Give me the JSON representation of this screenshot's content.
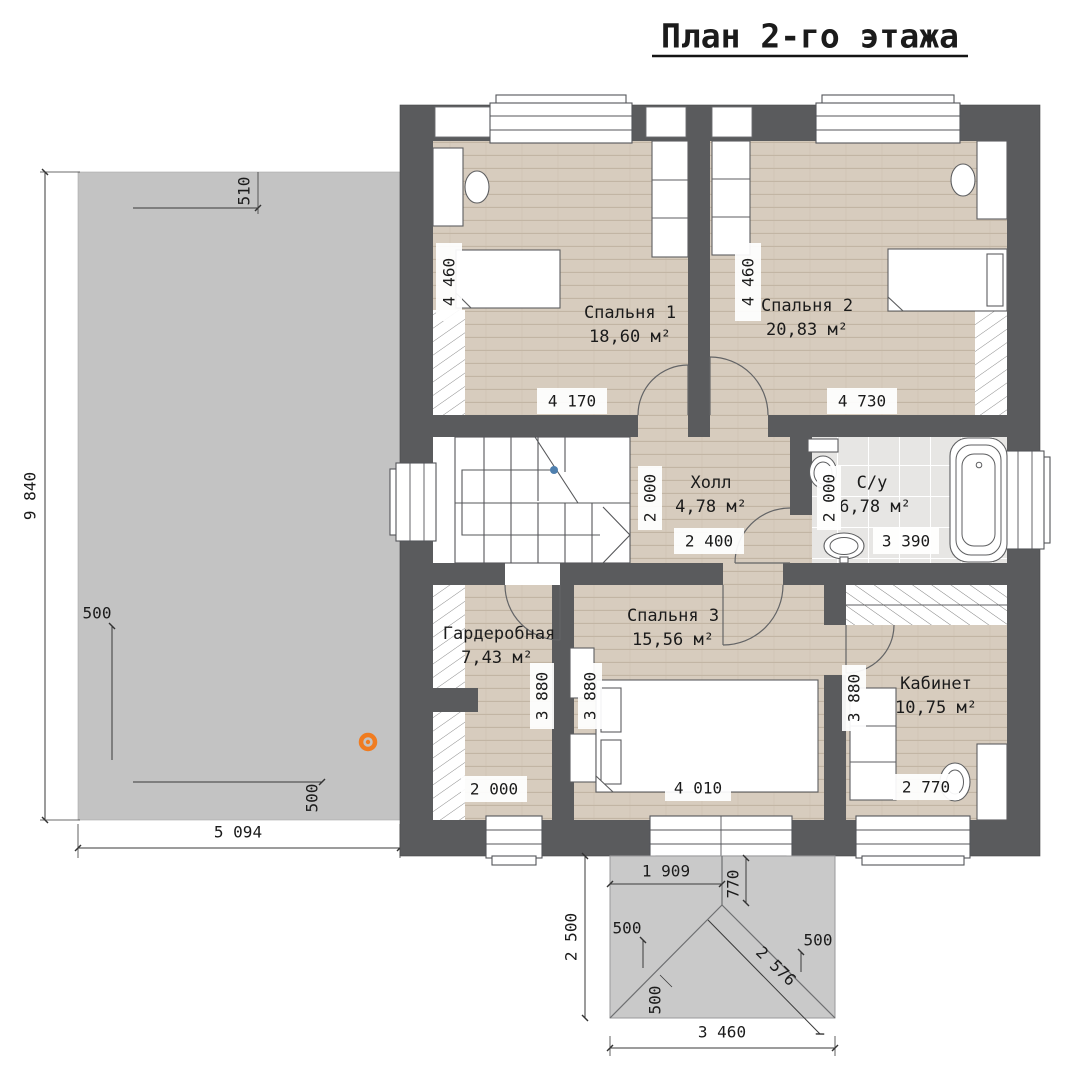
{
  "title": "План 2-го этажа",
  "rooms": {
    "bedroom1": {
      "name": "Спальня 1",
      "area": "18,60 м²"
    },
    "bedroom2": {
      "name": "Спальня 2",
      "area": "20,83 м²"
    },
    "hall": {
      "name": "Холл",
      "area": "4,78 м²"
    },
    "bathroom": {
      "name": "С/у",
      "area": "6,78 м²"
    },
    "wardrobe": {
      "name": "Гардеробная",
      "area": "7,43 м²"
    },
    "bedroom3": {
      "name": "Спальня 3",
      "area": "15,56 м²"
    },
    "office": {
      "name": "Кабинет",
      "area": "10,75 м²"
    }
  },
  "dims": {
    "terrace_height": "9 840",
    "terrace_510": "510",
    "terrace_500_top": "500",
    "terrace_500_bottom": "500",
    "terrace_width": "5 094",
    "bed1_v": "4 460",
    "bed1_h": "4 170",
    "bed2_v": "4 460",
    "bed2_h": "4 730",
    "hall_v": "2 000",
    "hall_h": "2 400",
    "bath_v": "2 000",
    "bath_h": "3 390",
    "ward_v": "3 880",
    "ward_h": "2 000",
    "bed3_v": "3 880",
    "bed3_h": "4 010",
    "office_v": "3 880",
    "office_h": "2 770",
    "porch_1909": "1 909",
    "porch_770": "770",
    "porch_2500": "2 500",
    "porch_500_left": "500",
    "porch_500_right": "500",
    "porch_500_bottom": "500",
    "porch_2576": "2 576",
    "porch_3460": "3 460"
  },
  "colors": {
    "wall": "#5a5b5d",
    "wood": "#d7ccbe",
    "wood_line": "#c2b5a4",
    "tile": "#e7e6e4",
    "tile_line": "#ffffff",
    "terrace": "#c3c3c3",
    "porch": "#c9c9c9",
    "line": "#3a3a3a",
    "text": "#1b1b1b",
    "marker_orange": "#f07c20",
    "stair_dot": "#4e7fae"
  }
}
